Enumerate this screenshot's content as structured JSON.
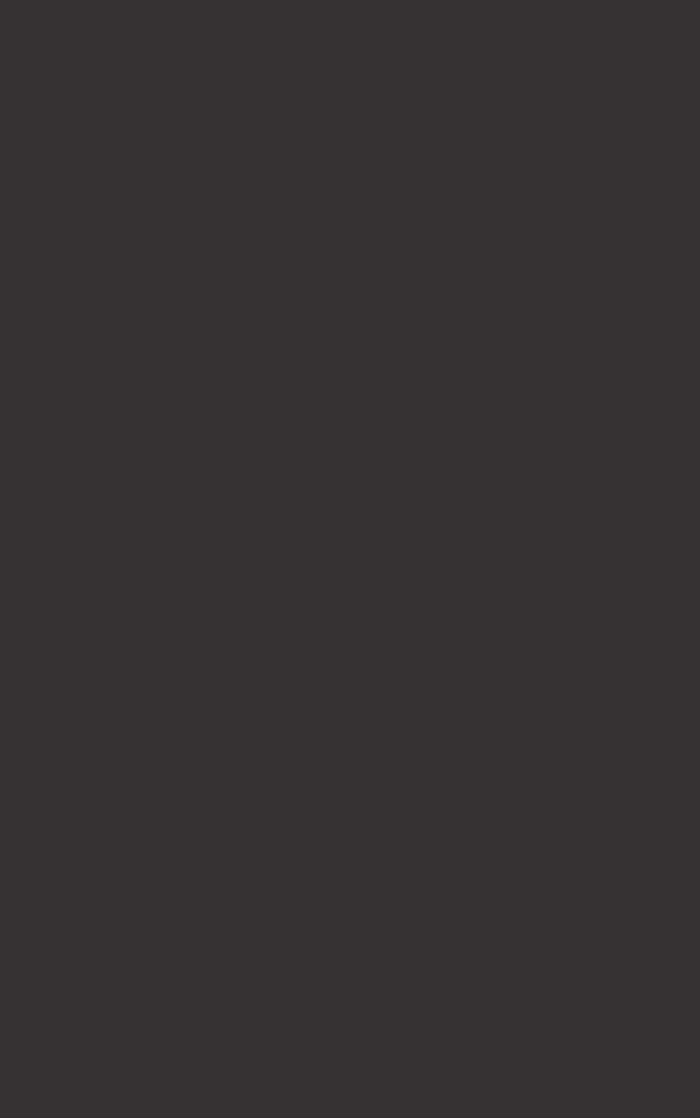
{
  "screen": {
    "state": "blank",
    "background_color": "#363233"
  }
}
